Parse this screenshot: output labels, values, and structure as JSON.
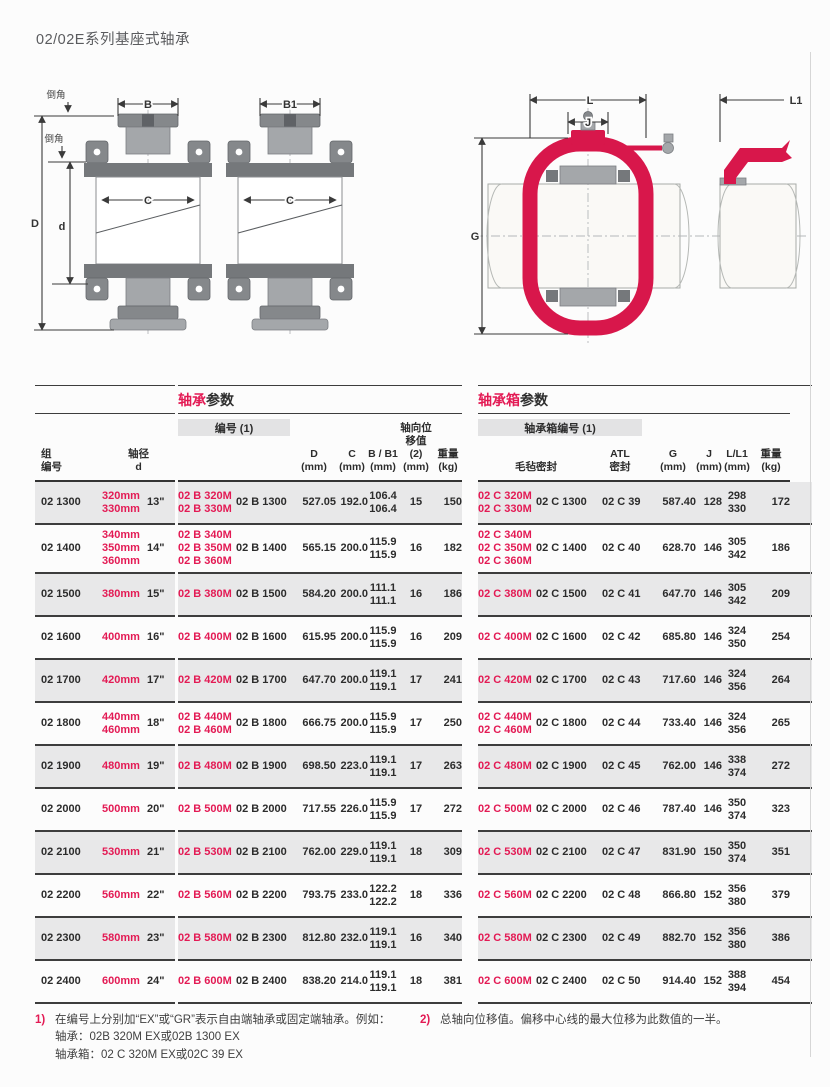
{
  "colors": {
    "accent_red": "#e31a54",
    "zebra_gray": "#e8e8e9",
    "rule_dark": "#3d3d3d",
    "housing_red": "#d8174b"
  },
  "page": {
    "title": "02/02E系列基座式轴承"
  },
  "diagram": {
    "bearing": {
      "chamfer_top": "倒角",
      "chamfer_inner": "倒角",
      "dim_B": "B",
      "dim_B1": "B1",
      "dim_C": "C",
      "dim_D": "D",
      "dim_d": "d"
    },
    "housing": {
      "dim_L": "L",
      "dim_J": "J",
      "dim_L1": "L1",
      "dim_G": "G"
    }
  },
  "left_header": {
    "group_l1": "组",
    "group_l2": "编号",
    "shaft_l1": "轴径",
    "shaft_l2": "d"
  },
  "bearing_table": {
    "title_red": "轴承",
    "title_black": "参数",
    "desig_header": "编号 (1)",
    "col_D": "D",
    "col_C": "C",
    "col_BB1": "B / B1",
    "axial_l1": "轴向位",
    "axial_l2": "移值 (2)",
    "col_weight": "重量",
    "unit_mm": "(mm)",
    "unit_kg": "(kg)"
  },
  "housing_table": {
    "title_red": "轴承箱",
    "title_black": "参数",
    "desig_header": "轴承箱编号 (1)",
    "felt_seal": "毛毡密封",
    "atl_l1": "ATL",
    "atl_l2": "密封",
    "col_G": "G",
    "col_J": "J",
    "col_LL1": "L/L1",
    "col_weight": "重量",
    "unit_mm": "(mm)",
    "unit_kg": "(kg)"
  },
  "rows": [
    {
      "group": "02 1300",
      "size_mm": [
        "320mm",
        "330mm"
      ],
      "size_in": "13\"",
      "brg_inch": [
        "02 B 320M",
        "02 B 330M"
      ],
      "brg_metric": "02 B 1300",
      "D": "527.05",
      "C": "192.0",
      "B_B1": [
        "106.4",
        "106.4"
      ],
      "axial": "15",
      "weight": "150",
      "hsg_felt_inch": [
        "02 C 320M",
        "02 C 330M"
      ],
      "hsg_felt_metric": "02 C 1300",
      "hsg_atl": "02 C 39",
      "G": "587.40",
      "J": "128",
      "L_L1": [
        "298",
        "330"
      ],
      "hsg_weight": "172"
    },
    {
      "group": "02 1400",
      "size_mm": [
        "340mm",
        "350mm",
        "360mm"
      ],
      "size_in": "14\"",
      "brg_inch": [
        "02 B 340M",
        "02 B 350M",
        "02 B 360M"
      ],
      "brg_metric": "02 B 1400",
      "D": "565.15",
      "C": "200.0",
      "B_B1": [
        "115.9",
        "115.9"
      ],
      "axial": "16",
      "weight": "182",
      "hsg_felt_inch": [
        "02 C 340M",
        "02 C 350M",
        "02 C 360M"
      ],
      "hsg_felt_metric": "02 C 1400",
      "hsg_atl": "02 C 40",
      "G": "628.70",
      "J": "146",
      "L_L1": [
        "305",
        "342"
      ],
      "hsg_weight": "186"
    },
    {
      "group": "02 1500",
      "size_mm": [
        "380mm"
      ],
      "size_in": "15\"",
      "brg_inch": [
        "02 B 380M"
      ],
      "brg_metric": "02 B 1500",
      "D": "584.20",
      "C": "200.0",
      "B_B1": [
        "111.1",
        "111.1"
      ],
      "axial": "16",
      "weight": "186",
      "hsg_felt_inch": [
        "02 C 380M"
      ],
      "hsg_felt_metric": "02 C 1500",
      "hsg_atl": "02 C 41",
      "G": "647.70",
      "J": "146",
      "L_L1": [
        "305",
        "342"
      ],
      "hsg_weight": "209"
    },
    {
      "group": "02 1600",
      "size_mm": [
        "400mm"
      ],
      "size_in": "16\"",
      "brg_inch": [
        "02 B 400M"
      ],
      "brg_metric": "02 B 1600",
      "D": "615.95",
      "C": "200.0",
      "B_B1": [
        "115.9",
        "115.9"
      ],
      "axial": "16",
      "weight": "209",
      "hsg_felt_inch": [
        "02 C 400M"
      ],
      "hsg_felt_metric": "02 C 1600",
      "hsg_atl": "02 C 42",
      "G": "685.80",
      "J": "146",
      "L_L1": [
        "324",
        "350"
      ],
      "hsg_weight": "254"
    },
    {
      "group": "02 1700",
      "size_mm": [
        "420mm"
      ],
      "size_in": "17\"",
      "brg_inch": [
        "02 B 420M"
      ],
      "brg_metric": "02 B 1700",
      "D": "647.70",
      "C": "200.0",
      "B_B1": [
        "119.1",
        "119.1"
      ],
      "axial": "17",
      "weight": "241",
      "hsg_felt_inch": [
        "02 C 420M"
      ],
      "hsg_felt_metric": "02 C 1700",
      "hsg_atl": "02 C 43",
      "G": "717.60",
      "J": "146",
      "L_L1": [
        "324",
        "356"
      ],
      "hsg_weight": "264"
    },
    {
      "group": "02 1800",
      "size_mm": [
        "440mm",
        "460mm"
      ],
      "size_in": "18\"",
      "brg_inch": [
        "02 B 440M",
        "02 B 460M"
      ],
      "brg_metric": "02 B 1800",
      "D": "666.75",
      "C": "200.0",
      "B_B1": [
        "115.9",
        "115.9"
      ],
      "axial": "17",
      "weight": "250",
      "hsg_felt_inch": [
        "02 C 440M",
        "02 C 460M"
      ],
      "hsg_felt_metric": "02 C 1800",
      "hsg_atl": "02 C 44",
      "G": "733.40",
      "J": "146",
      "L_L1": [
        "324",
        "356"
      ],
      "hsg_weight": "265"
    },
    {
      "group": "02 1900",
      "size_mm": [
        "480mm"
      ],
      "size_in": "19\"",
      "brg_inch": [
        "02 B 480M"
      ],
      "brg_metric": "02 B 1900",
      "D": "698.50",
      "C": "223.0",
      "B_B1": [
        "119.1",
        "119.1"
      ],
      "axial": "17",
      "weight": "263",
      "hsg_felt_inch": [
        "02 C 480M"
      ],
      "hsg_felt_metric": "02 C 1900",
      "hsg_atl": "02 C 45",
      "G": "762.00",
      "J": "146",
      "L_L1": [
        "338",
        "374"
      ],
      "hsg_weight": "272"
    },
    {
      "group": "02 2000",
      "size_mm": [
        "500mm"
      ],
      "size_in": "20\"",
      "brg_inch": [
        "02 B 500M"
      ],
      "brg_metric": "02 B 2000",
      "D": "717.55",
      "C": "226.0",
      "B_B1": [
        "115.9",
        "115.9"
      ],
      "axial": "17",
      "weight": "272",
      "hsg_felt_inch": [
        "02 C 500M"
      ],
      "hsg_felt_metric": "02 C 2000",
      "hsg_atl": "02 C 46",
      "G": "787.40",
      "J": "146",
      "L_L1": [
        "350",
        "374"
      ],
      "hsg_weight": "323"
    },
    {
      "group": "02 2100",
      "size_mm": [
        "530mm"
      ],
      "size_in": "21\"",
      "brg_inch": [
        "02 B 530M"
      ],
      "brg_metric": "02 B 2100",
      "D": "762.00",
      "C": "229.0",
      "B_B1": [
        "119.1",
        "119.1"
      ],
      "axial": "18",
      "weight": "309",
      "hsg_felt_inch": [
        "02 C 530M"
      ],
      "hsg_felt_metric": "02 C 2100",
      "hsg_atl": "02 C 47",
      "G": "831.90",
      "J": "150",
      "L_L1": [
        "350",
        "374"
      ],
      "hsg_weight": "351"
    },
    {
      "group": "02 2200",
      "size_mm": [
        "560mm"
      ],
      "size_in": "22\"",
      "brg_inch": [
        "02 B 560M"
      ],
      "brg_metric": "02 B 2200",
      "D": "793.75",
      "C": "233.0",
      "B_B1": [
        "122.2",
        "122.2"
      ],
      "axial": "18",
      "weight": "336",
      "hsg_felt_inch": [
        "02 C 560M"
      ],
      "hsg_felt_metric": "02 C 2200",
      "hsg_atl": "02 C 48",
      "G": "866.80",
      "J": "152",
      "L_L1": [
        "356",
        "380"
      ],
      "hsg_weight": "379"
    },
    {
      "group": "02 2300",
      "size_mm": [
        "580mm"
      ],
      "size_in": "23\"",
      "brg_inch": [
        "02 B 580M"
      ],
      "brg_metric": "02 B 2300",
      "D": "812.80",
      "C": "232.0",
      "B_B1": [
        "119.1",
        "119.1"
      ],
      "axial": "16",
      "weight": "340",
      "hsg_felt_inch": [
        "02 C 580M"
      ],
      "hsg_felt_metric": "02 C 2300",
      "hsg_atl": "02 C 49",
      "G": "882.70",
      "J": "152",
      "L_L1": [
        "356",
        "380"
      ],
      "hsg_weight": "386"
    },
    {
      "group": "02 2400",
      "size_mm": [
        "600mm"
      ],
      "size_in": "24\"",
      "brg_inch": [
        "02 B 600M"
      ],
      "brg_metric": "02 B 2400",
      "D": "838.20",
      "C": "214.0",
      "B_B1": [
        "119.1",
        "119.1"
      ],
      "axial": "18",
      "weight": "381",
      "hsg_felt_inch": [
        "02 C 600M"
      ],
      "hsg_felt_metric": "02 C 2400",
      "hsg_atl": "02 C 50",
      "G": "914.40",
      "J": "152",
      "L_L1": [
        "388",
        "394"
      ],
      "hsg_weight": "454"
    }
  ],
  "footnotes": {
    "fn1": {
      "marker": "1)",
      "p1": "在编号上分别加“EX”或“GR”表示自由端轴承或固定端轴承。例如：轴承：02B 320M EX或02B 1300 EX",
      "p2": "轴承箱：02 C 320M EX或02C 39 EX"
    },
    "fn2": {
      "marker": "2)",
      "text": "总轴向位移值。偏移中心线的最大位移为此数值的一半。"
    }
  }
}
